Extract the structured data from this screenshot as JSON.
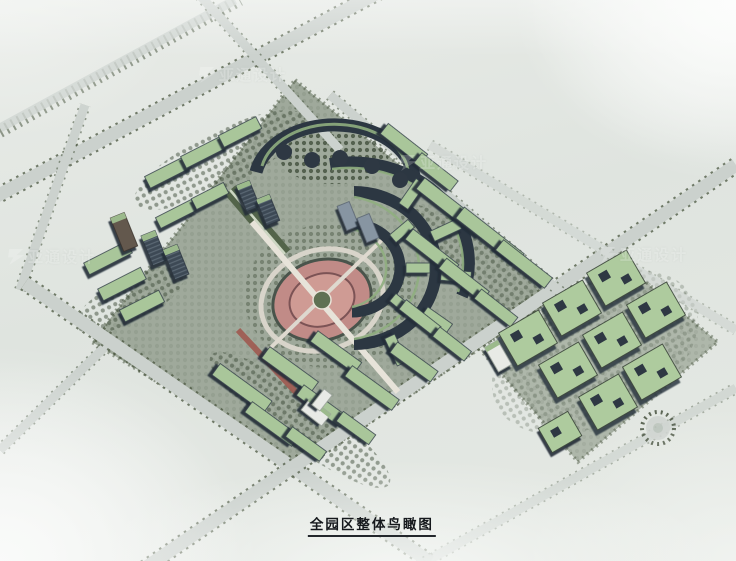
{
  "figure": {
    "caption": "全园区整体鸟瞰图",
    "type": "architectural-aerial-rendering",
    "subject": "residential master plan bird's-eye view"
  },
  "watermark": {
    "text": "亚通设计",
    "logo": "lightning-mark",
    "instances": 4
  },
  "palette": {
    "background": "#e2e6e2",
    "haze_white": "#fafbfa",
    "road": "#cbd1cd",
    "tree_green": "#49563f",
    "roof_green": "#a9c69a",
    "building_wall": "#3d4855",
    "plaza_pink": "#c18b87",
    "plaza_center_green": "#5f7153",
    "caption_color": "#15181c"
  }
}
